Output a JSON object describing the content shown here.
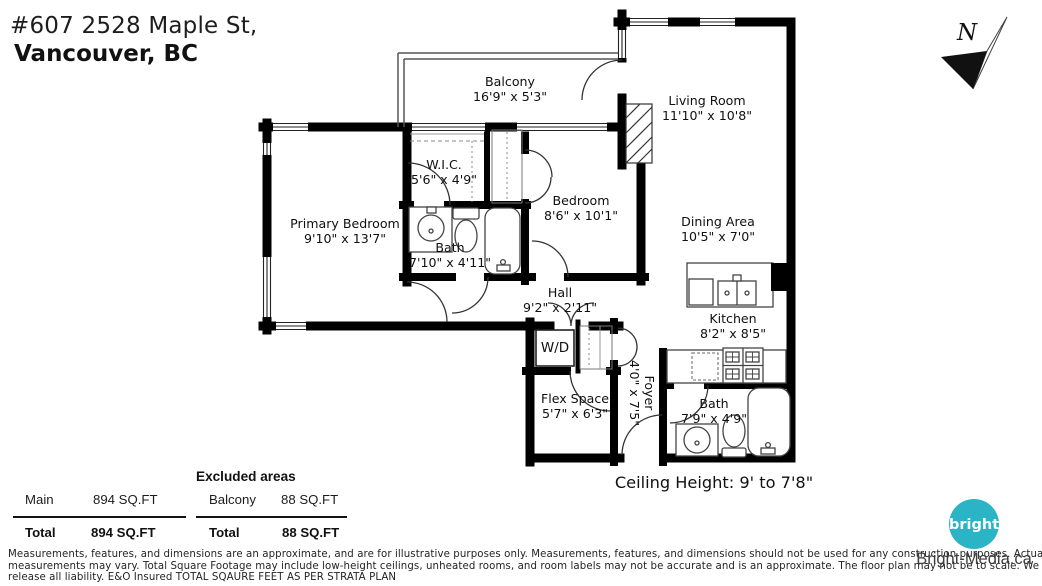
{
  "title": {
    "line1": "#607 2528 Maple St,",
    "line2": "Vancouver, BC"
  },
  "north_label": "N",
  "rooms": {
    "balcony": {
      "name": "Balcony",
      "dims": "16'9\" x 5'3\""
    },
    "living_room": {
      "name": "Living Room",
      "dims": "11'10\" x 10'8\""
    },
    "wic": {
      "name": "W.I.C.",
      "dims": "5'6\" x 4'9\""
    },
    "bedroom": {
      "name": "Bedroom",
      "dims": "8'6\" x 10'1\""
    },
    "primary_bedroom": {
      "name": "Primary Bedroom",
      "dims": "9'10\" x 13'7\""
    },
    "bath1": {
      "name": "Bath",
      "dims": "7'10\" x 4'11\""
    },
    "dining": {
      "name": "Dining Area",
      "dims": "10'5\" x 7'0\""
    },
    "hall": {
      "name": "Hall",
      "dims": "9'2\" x 2'11\""
    },
    "kitchen": {
      "name": "Kitchen",
      "dims": "8'2\" x 8'5\""
    },
    "laundry": {
      "label": "W/D"
    },
    "flex": {
      "name": "Flex Space",
      "dims": "5'7\" x 6'3\""
    },
    "foyer": {
      "name": "Foyer",
      "dims": "4'0\" x 7'5\""
    },
    "bath2": {
      "name": "Bath",
      "dims": "7'9\" x 4'9\""
    }
  },
  "ceiling_height": "Ceiling Height: 9' to 7'8\"",
  "area_table": {
    "main_row": {
      "label": "Main",
      "value": "894 SQ.FT"
    },
    "main_total": {
      "label": "Total",
      "value": "894 SQ.FT"
    },
    "excluded_heading": "Excluded areas",
    "excluded_row": {
      "label": "Balcony",
      "value": "88 SQ.FT"
    },
    "excluded_total": {
      "label": "Total",
      "value": "88 SQ.FT"
    }
  },
  "disclaimer": {
    "line1": "Measurements, features, and dimensions are an approximate, and are for illustrative purposes only. Measurements, features, and dimensions should not be used for any construction purposes. Actual",
    "line2": "measurements may vary. Total Square Footage may include low-height ceilings, unheated rooms, and room labels may not be accurate and is an approximate. The floor plan may not be to scale. We",
    "line3": "release all liability. E&O Insured  TOTAL SQAURE FEET AS PER STRATA PLAN"
  },
  "branding": {
    "logo_text": "bright",
    "website": "Bright-Media.ca",
    "logo_color": "#2bb4c6"
  }
}
